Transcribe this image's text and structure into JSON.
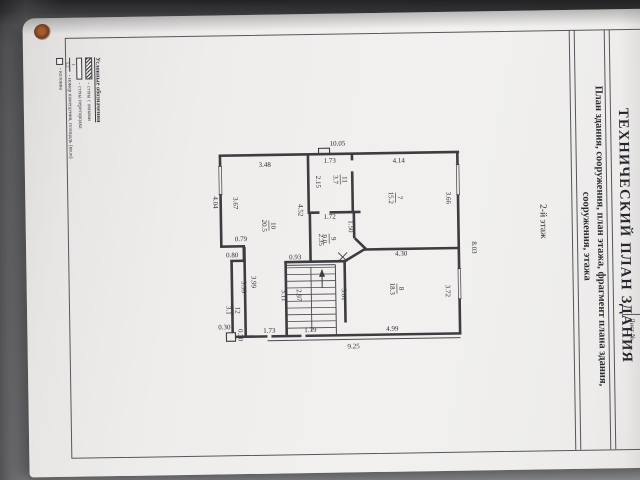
{
  "document": {
    "title": "ТЕХНИЧЕСКИЙ ПЛАН ЗДАНИЯ",
    "subtitle": "План здания, сооружения, план этажа, фрагмент плана здания, сооружения, этажа",
    "sheet_label": "Лист № ___",
    "floor_label": "2-й этаж"
  },
  "legend": {
    "header": "Условные обозначения",
    "items": [
      {
        "label": "- стена с окнами"
      },
      {
        "label": "- стена перегородка"
      },
      {
        "label": "- номер помещения, площадь (кв.м)",
        "sym_n": "1",
        "sym_d": "5,2"
      },
      {
        "label": "- колонна"
      }
    ]
  },
  "plan": {
    "overall_dimensions": {
      "top": "10.05",
      "bottom": "9.25",
      "right": "8.03",
      "left": "4.04"
    },
    "rooms": [
      {
        "number": "7",
        "area": "15.2"
      },
      {
        "number": "8",
        "area": "18.3"
      },
      {
        "number": "9",
        "area": "9.0"
      },
      {
        "number": "10",
        "area": "20.5"
      },
      {
        "number": "11",
        "area": "3.7"
      },
      {
        "number": "12",
        "area": "3.1"
      }
    ],
    "dim_labels": [
      {
        "t": "10.05",
        "x": 131,
        "y": 11,
        "r": 0
      },
      {
        "t": "3.48",
        "x": 58,
        "y": 31,
        "r": 0
      },
      {
        "t": "1.73",
        "x": 123,
        "y": 28,
        "r": 0
      },
      {
        "t": "4.14",
        "x": 192,
        "y": 29,
        "r": 0
      },
      {
        "t": "2.15",
        "x": 109,
        "y": 47,
        "r": 90
      },
      {
        "t": "4.04",
        "x": 6,
        "y": 66,
        "r": 90
      },
      {
        "t": "3.67",
        "x": 26,
        "y": 67,
        "r": 90
      },
      {
        "t": "3.66",
        "x": 239,
        "y": 65,
        "r": 90
      },
      {
        "t": "4.52",
        "x": 91,
        "y": 75,
        "r": 90
      },
      {
        "t": "1.72",
        "x": 122,
        "y": 84,
        "r": 0
      },
      {
        "t": "1.50",
        "x": 141,
        "y": 92,
        "r": 90
      },
      {
        "t": "2.35",
        "x": 111,
        "y": 105,
        "r": 90
      },
      {
        "t": "0.79",
        "x": 33,
        "y": 105,
        "r": 0
      },
      {
        "t": "0.80",
        "x": 24,
        "y": 121,
        "r": 0
      },
      {
        "t": "0.93",
        "x": 87,
        "y": 124,
        "r": 0
      },
      {
        "t": "4.30",
        "x": 193,
        "y": 122,
        "r": 0
      },
      {
        "t": "8.03",
        "x": 264,
        "y": 115,
        "r": 90
      },
      {
        "t": "3.72",
        "x": 237,
        "y": 158,
        "r": 90
      },
      {
        "t": "3.99",
        "x": 33,
        "y": 151,
        "r": 90
      },
      {
        "t": "3.99",
        "x": 43,
        "y": 146,
        "r": 90
      },
      {
        "t": "3.11",
        "x": 73,
        "y": 160,
        "r": 90
      },
      {
        "t": "2.97",
        "x": 88,
        "y": 160,
        "r": 90
      },
      {
        "t": "3.01",
        "x": 133,
        "y": 160,
        "r": 90
      },
      {
        "t": "0.30",
        "x": 15,
        "y": 193,
        "r": 0
      },
      {
        "t": "0.30",
        "x": 29,
        "y": 199,
        "r": 90
      },
      {
        "t": "1.73",
        "x": 60,
        "y": 197,
        "r": 0
      },
      {
        "t": "1.79",
        "x": 101,
        "y": 197,
        "r": 0
      },
      {
        "t": "4.99",
        "x": 183,
        "y": 197,
        "r": 0
      },
      {
        "t": "9.25",
        "x": 144,
        "y": 214,
        "r": 0
      }
    ],
    "room_labels": [
      {
        "n": "7",
        "a": "15.2",
        "x": 189,
        "y": 64
      },
      {
        "n": "8",
        "a": "18.3",
        "x": 189,
        "y": 155
      },
      {
        "n": "9",
        "a": "9.0",
        "x": 122,
        "y": 104
      },
      {
        "n": "10",
        "a": "20.5",
        "x": 62,
        "y": 90
      },
      {
        "n": "11",
        "a": "3.7",
        "x": 134,
        "y": 45
      },
      {
        "n": "12",
        "a": "3.1",
        "x": 25,
        "y": 174
      }
    ]
  }
}
